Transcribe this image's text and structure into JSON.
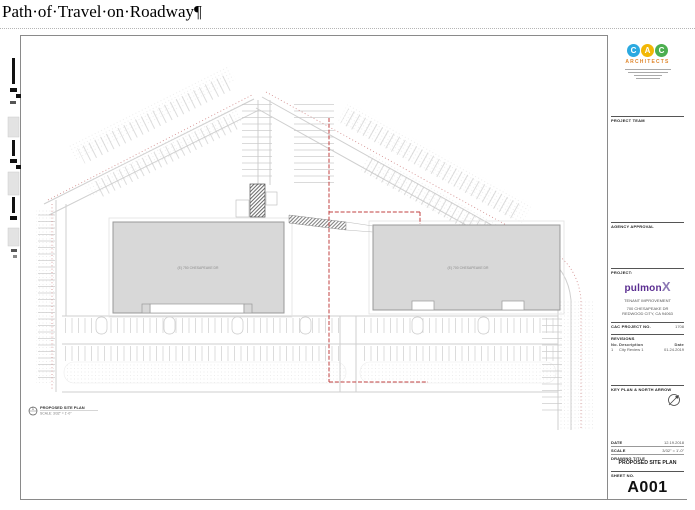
{
  "document": {
    "title": "Path·of·Travel·on·Roadway¶"
  },
  "sheet": {
    "plan": {
      "building_left_label": "(E) 750 CHESAPEAKE DR",
      "building_right_label": "(E) 700 CHESAPEAKE DR",
      "callout_number": "1",
      "callout_title": "PROPOSED SITE PLAN",
      "callout_scale": "SCALE: 3/32\" = 1'-0\""
    },
    "titleblock": {
      "firm": {
        "letters": [
          "C",
          "A",
          "C"
        ],
        "name": "ARCHITECTS"
      },
      "sections": {
        "project_team": "PROJECT TEAM",
        "agency_approval": "AGENCY APPROVAL",
        "project": "PROJECT:",
        "revisions": "REVISIONS",
        "key_plan": "KEY PLAN & NORTH ARROW",
        "project_no_label": "CAC PROJECT NO.",
        "date_label": "DATE",
        "scale_label": "SCALE",
        "drawing_title_label": "DRAWING TITLE",
        "sheet_no_label": "SHEET NO."
      },
      "project": {
        "logo_main": "pulmon",
        "logo_x": "X",
        "name": "TENANT IMPROVEMENT",
        "address_line1": "700 CHESAPEAKE DR",
        "address_line2": "REDWOOD CITY, CA 94063"
      },
      "values": {
        "project_no": "1708",
        "date": "12.19.2018",
        "scale": "3/32\" = 1'-0\"",
        "drawing_title": "PROPOSED SITE PLAN",
        "sheet_no": "A001"
      },
      "revisions_table": {
        "headers": [
          "No.",
          "Description",
          "Date"
        ],
        "rows": [
          [
            "1",
            "City Review 1",
            "01.24.2019"
          ]
        ]
      }
    },
    "colors": {
      "logo_c1": "#2BA9E0",
      "logo_a": "#F2B705",
      "logo_c2": "#4CAF50",
      "architects_text": "#E0882F",
      "pulmonx_purple": "#5B2E91",
      "path_of_travel_red": "#C04040",
      "property_line_red": "#D08888",
      "building_fill": "#D8D8D8"
    }
  }
}
